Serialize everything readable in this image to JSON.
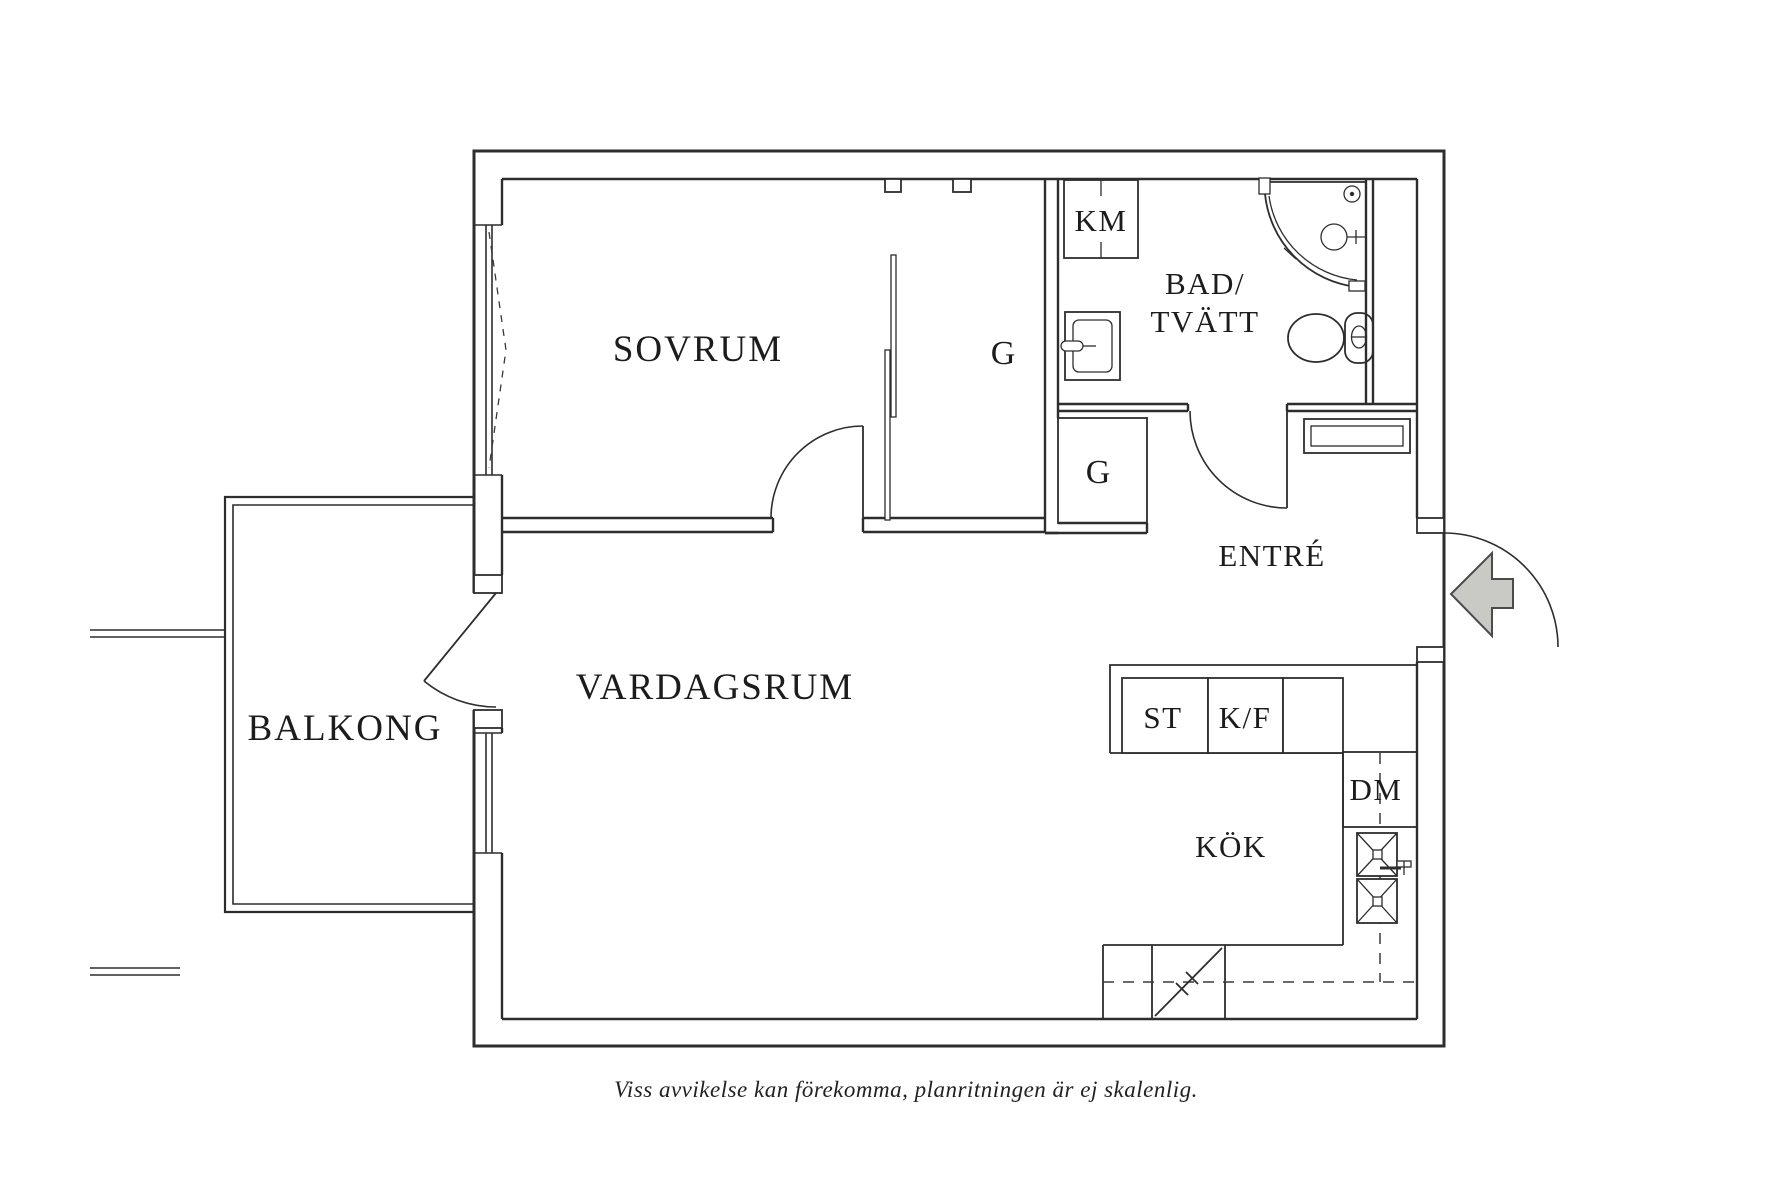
{
  "floorplan": {
    "rooms": {
      "sovrum": "SOVRUM",
      "vardagsrum": "VARDAGSRUM",
      "balkong": "BALKONG",
      "entre": "ENTRÉ",
      "kok": "KÖK",
      "bad_line1": "BAD/",
      "bad_line2": "TVÄTT"
    },
    "closets": {
      "g_sovrum": "G",
      "g_entre": "G"
    },
    "appliances": {
      "km": "KM",
      "st": "ST",
      "kf": "K/F",
      "dm": "DM"
    },
    "disclaimer": "Viss avvikelse kan förekomma, planritningen är ej skalenlig.",
    "colors": {
      "line": "#2d2d2d",
      "background": "#ffffff",
      "entry_arrow_fill": "#c9c9c6",
      "entry_arrow_outline": "#4b4b4b"
    }
  }
}
